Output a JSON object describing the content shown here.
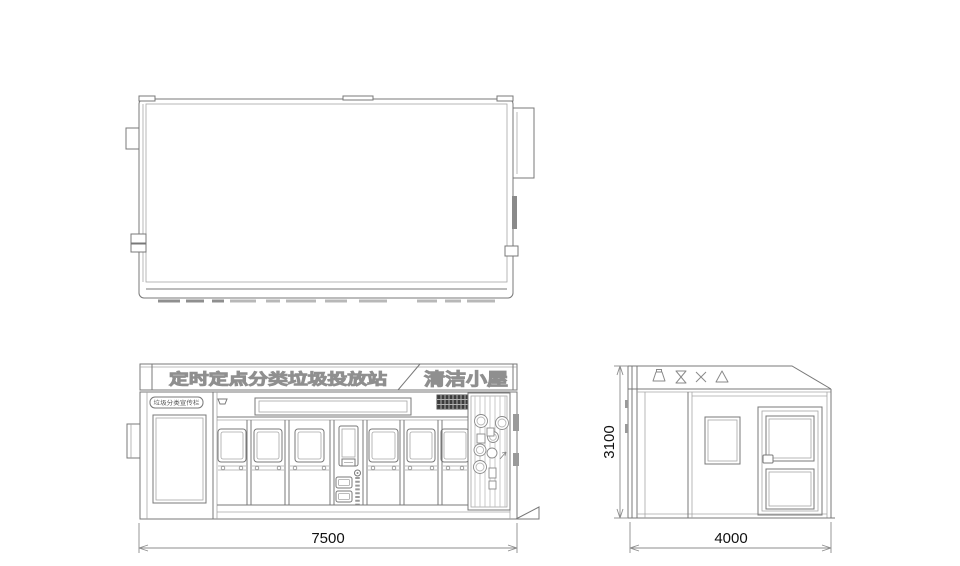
{
  "drawing": {
    "front": {
      "banner_title": "定时定点分类垃圾投放站",
      "banner_right": "清洁小屋",
      "info_label": "垃圾分类宣传栏"
    },
    "side": {
      "icons": [
        "bottle-icon",
        "hourglass-icon",
        "cross-icon",
        "triangle-icon"
      ]
    },
    "dimensions": {
      "front_width": "7500",
      "side_depth": "4000",
      "height": "3100"
    },
    "colors": {
      "line": "#787878",
      "light_line": "#a6a6a6",
      "grille_dark": "#3c3c3c",
      "vent_gray": "#9a9a9a",
      "dimension_text": "#111111",
      "outline_text_stroke": "#8f8f8f",
      "background": "#ffffff"
    }
  }
}
